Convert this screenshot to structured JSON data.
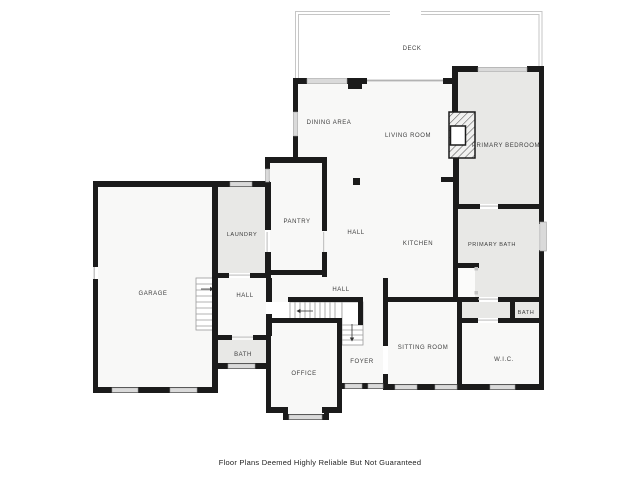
{
  "page": {
    "footer": "Floor Plans Deemed Highly Reliable But Not Guaranteed",
    "background": "#ffffff"
  },
  "palette": {
    "wall": "#1b1b1b",
    "room": "#f8f8f7",
    "shaded_room": "#e8e8e6",
    "window_fill": "#dadada",
    "window_border": "#979797",
    "deck_rail": "#c6c6c6",
    "stair_line": "#9a9a9a",
    "door_line": "#c4c4c4",
    "label_text": "#404040",
    "footer_text": "#222222"
  },
  "rooms": {
    "deck": "DECK",
    "dining": "DINING AREA",
    "living": "LIVING ROOM",
    "primary_bedroom": "PRIMARY BEDROOM",
    "laundry": "LAUNDRY",
    "pantry": "PANTRY",
    "hall_upper": "HALL",
    "kitchen": "KITCHEN",
    "primary_bath": "PRIMARY BATH",
    "garage": "GARAGE",
    "hall_left": "HALL",
    "hall_center": "HALL",
    "bath_left": "BATH",
    "office": "OFFICE",
    "foyer": "FOYER",
    "sitting": "SITTING ROOM",
    "wic": "W.I.C.",
    "bath_right": "BATH"
  }
}
